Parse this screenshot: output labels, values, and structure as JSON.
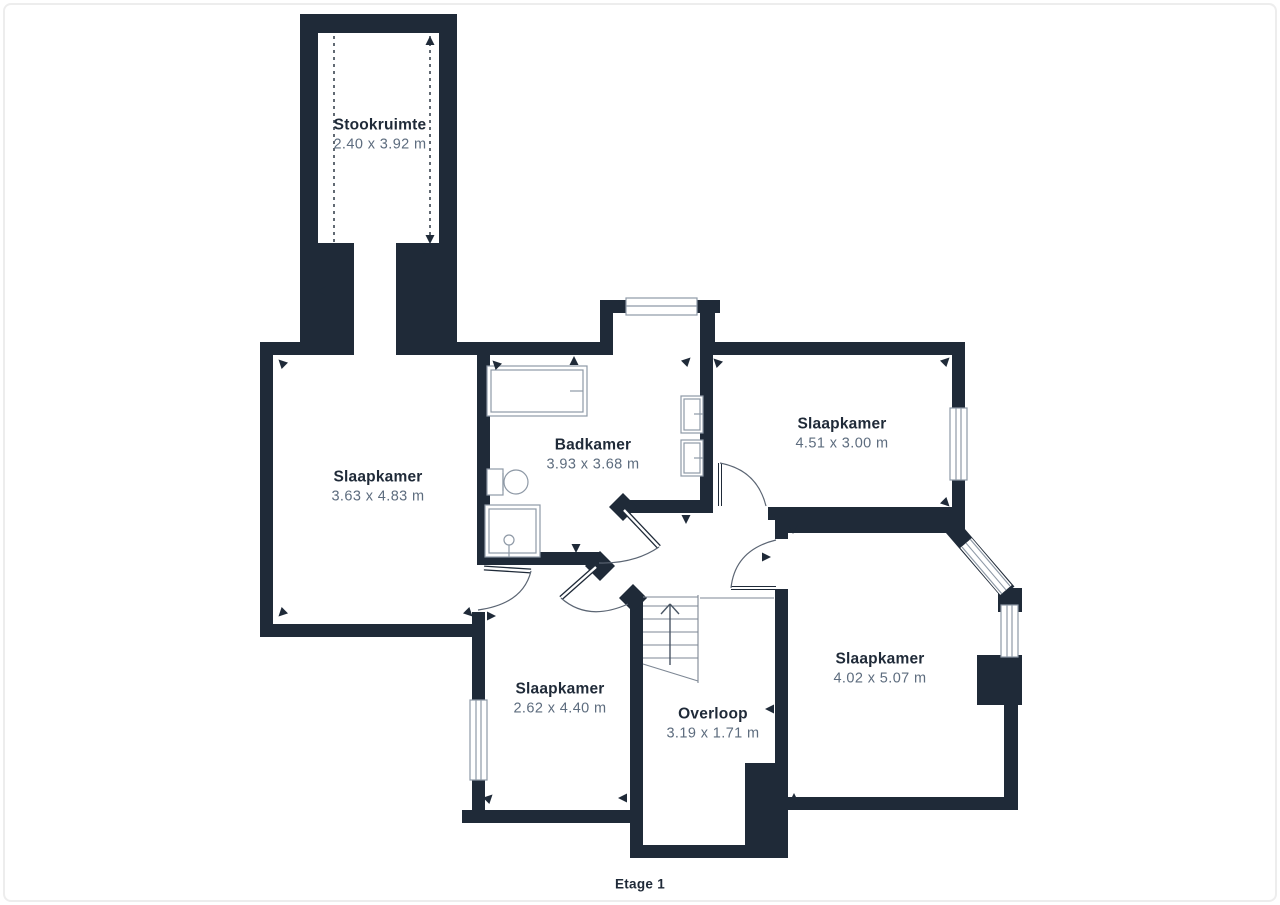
{
  "floorplan": {
    "floor_label": "Etage 1",
    "rooms": [
      {
        "name": "Stookruimte",
        "dimensions": "2.40 x 3.92 m"
      },
      {
        "name": "Slaapkamer",
        "dimensions": "3.63 x 4.83 m"
      },
      {
        "name": "Badkamer",
        "dimensions": "3.93 x 3.68 m"
      },
      {
        "name": "Slaapkamer",
        "dimensions": "4.51 x 3.00 m"
      },
      {
        "name": "Slaapkamer",
        "dimensions": "2.62 x 4.40 m"
      },
      {
        "name": "Overloop",
        "dimensions": "3.19 x 1.71 m"
      },
      {
        "name": "Slaapkamer",
        "dimensions": "4.02 x 5.07 m"
      }
    ],
    "fixtures": [
      "bathtub",
      "toilet",
      "shower",
      "sink",
      "sink",
      "staircase"
    ],
    "colors": {
      "wall": "#1f2a38",
      "room_name_text": "#1f2a38",
      "dimension_text": "#5d6c7e",
      "fixture_outline": "#8e99a6",
      "door_arc": "#5b6573",
      "background": "#ffffff"
    }
  }
}
